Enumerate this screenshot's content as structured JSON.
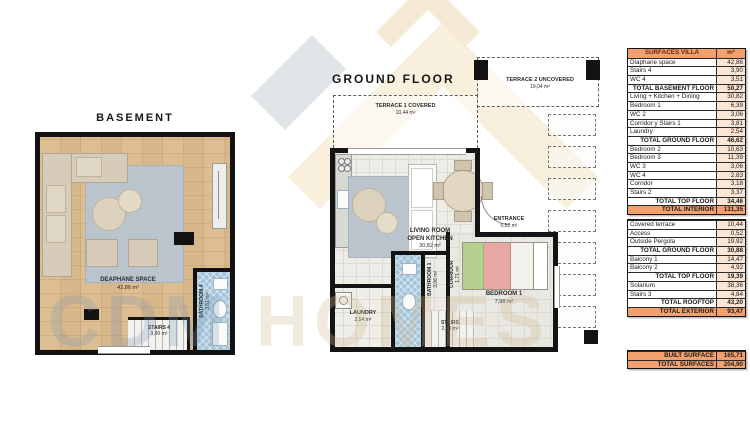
{
  "basement": {
    "title": "BASEMENT",
    "diaphane_name": "DEAPHANE SPACE",
    "diaphane_area": "42,86 m²",
    "stairs_name": "STAIRS 4",
    "stairs_area": "3,90 m²",
    "bathroom_name": "BATHROOM 4",
    "bathroom_area": "3,51 m²"
  },
  "ground": {
    "title": "GROUND FLOOR",
    "terrace2_name": "TERRACE 2 UNCOVERED",
    "terrace2_area": "19,04 m²",
    "terrace1_name": "TERRACE 1 COVERED",
    "terrace1_area": "10,44 m²",
    "living_name1": "LIVING ROOM",
    "living_name2": "OPEN KITCHEN",
    "living_area": "30,82 m²",
    "entrance_name": "ENTRANCE",
    "entrance_area": "0,52 m²",
    "bedroom_name": "BEDROOM 1",
    "bedroom_area": "7,98 m²",
    "corridor_name": "CORRIDOR",
    "corridor_area": "1,71 m²",
    "bathroom_name": "BATHROOM 1",
    "bathroom_area": "3,06 m²",
    "laundry_name": "LAUNDRY",
    "laundry_area": "2,54 m²",
    "stairs_name": "STAIRS",
    "stairs_area": "2,10 m²"
  },
  "watermark": {
    "left": "CDM",
    "right": "HOMES"
  },
  "table": {
    "header": {
      "label": "SURFACES VILLA",
      "unit": "m²"
    },
    "interior": [
      {
        "l": "Diaphane space",
        "v": "42,86",
        "t": "n"
      },
      {
        "l": "Stairs 4",
        "v": "3,90",
        "t": "n"
      },
      {
        "l": "WC 4",
        "v": "3,51",
        "t": "n"
      },
      {
        "l": "TOTAL BASEMENT FLOOR",
        "v": "50,27",
        "t": "s"
      },
      {
        "l": "Living + Kitchen + Dining",
        "v": "30,82",
        "t": "n"
      },
      {
        "l": "Bedroom 1",
        "v": "6,39",
        "t": "n"
      },
      {
        "l": "WC 2",
        "v": "3,06",
        "t": "n"
      },
      {
        "l": "Corridor y Stairs 1",
        "v": "3,81",
        "t": "n"
      },
      {
        "l": "Laundry",
        "v": "2,54",
        "t": "n"
      },
      {
        "l": "TOTAL GROUND FLOOR",
        "v": "46,62",
        "t": "s"
      },
      {
        "l": "Bedroom 2",
        "v": "10,63",
        "t": "n"
      },
      {
        "l": "Bedroom 3",
        "v": "11,39",
        "t": "n"
      },
      {
        "l": "WC 3",
        "v": "3,06",
        "t": "n"
      },
      {
        "l": "WC 4",
        "v": "2,83",
        "t": "n"
      },
      {
        "l": "Corridor",
        "v": "3,18",
        "t": "n"
      },
      {
        "l": "Stairs 2",
        "v": "3,37",
        "t": "n"
      },
      {
        "l": "TOTAL TOP FLOOR",
        "v": "34,46",
        "t": "s"
      },
      {
        "l": "TOTAL INTERIOR",
        "v": "131,35",
        "t": "g"
      }
    ],
    "exterior": [
      {
        "l": "Covered terrace",
        "v": "10,44",
        "t": "n"
      },
      {
        "l": "Access",
        "v": "0,52",
        "t": "n"
      },
      {
        "l": "Outside Pergola",
        "v": "19,92",
        "t": "n"
      },
      {
        "l": "TOTAL GROUND FLOOR",
        "v": "30,88",
        "t": "s"
      },
      {
        "l": "Balcony 1",
        "v": "14,47",
        "t": "n"
      },
      {
        "l": "Balcony 2",
        "v": "4,92",
        "t": "n"
      },
      {
        "l": "TOTAL TOP FLOOR",
        "v": "19,39",
        "t": "s"
      },
      {
        "l": "Solarium",
        "v": "38,36",
        "t": "n"
      },
      {
        "l": "Stairs 3",
        "v": "4,84",
        "t": "n"
      },
      {
        "l": "TOTAL ROOFTOP",
        "v": "43,20",
        "t": "s"
      },
      {
        "l": "TOTAL EXTERIOR",
        "v": "93,47",
        "t": "g"
      }
    ],
    "summary": [
      {
        "l": "BUILT SURFACE",
        "v": "165,71",
        "t": "g"
      },
      {
        "l": "TOTAL SURFACES",
        "v": "204,90",
        "t": "g"
      }
    ]
  },
  "colors": {
    "accent_orange": "#f1a06e",
    "value_peach": "#fbe6d5",
    "tile_blue": "#a4c4d9",
    "wood": "#d8b78a"
  }
}
